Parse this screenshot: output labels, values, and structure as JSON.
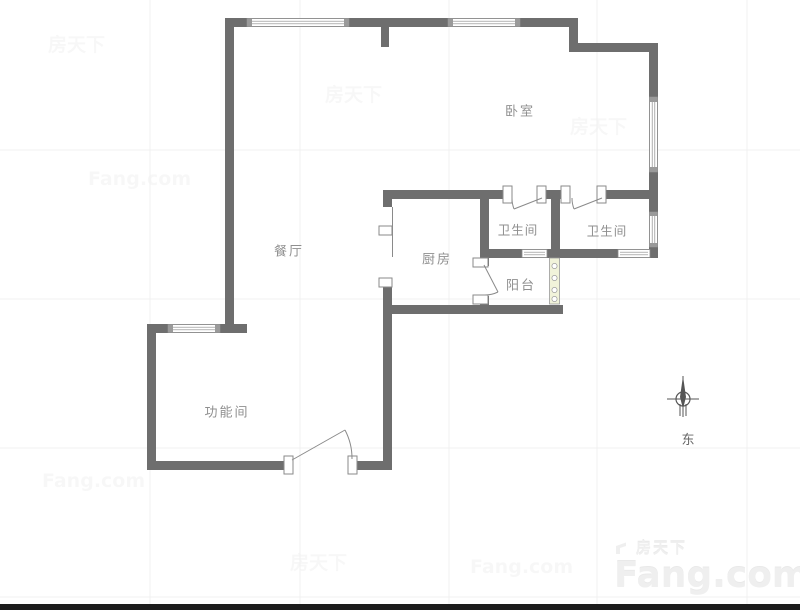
{
  "floorplan": {
    "rooms": {
      "bedroom": {
        "label": "卧室"
      },
      "dining": {
        "label": "餐厅"
      },
      "kitchen": {
        "label": "厨房"
      },
      "bathroom_left": {
        "label": "卫生间"
      },
      "bathroom_right": {
        "label": "卫生间"
      },
      "balcony": {
        "label": "阳台"
      },
      "function_room": {
        "label": "功能间"
      }
    },
    "compass": {
      "east_label": "东"
    }
  },
  "watermark": {
    "brand_cn": "房天下",
    "brand_en": "Fang.com"
  },
  "colors": {
    "wall": "#6e6e6e",
    "room_label": "#8f8f8f",
    "window_stroke": "#8a8a8a",
    "door_stroke": "#8a8a8a",
    "balcony_door_fill": "#f1f3da",
    "grid_line": "#f0f0f0",
    "compass": "#555555",
    "footer_bar": "#1c1c1c"
  }
}
